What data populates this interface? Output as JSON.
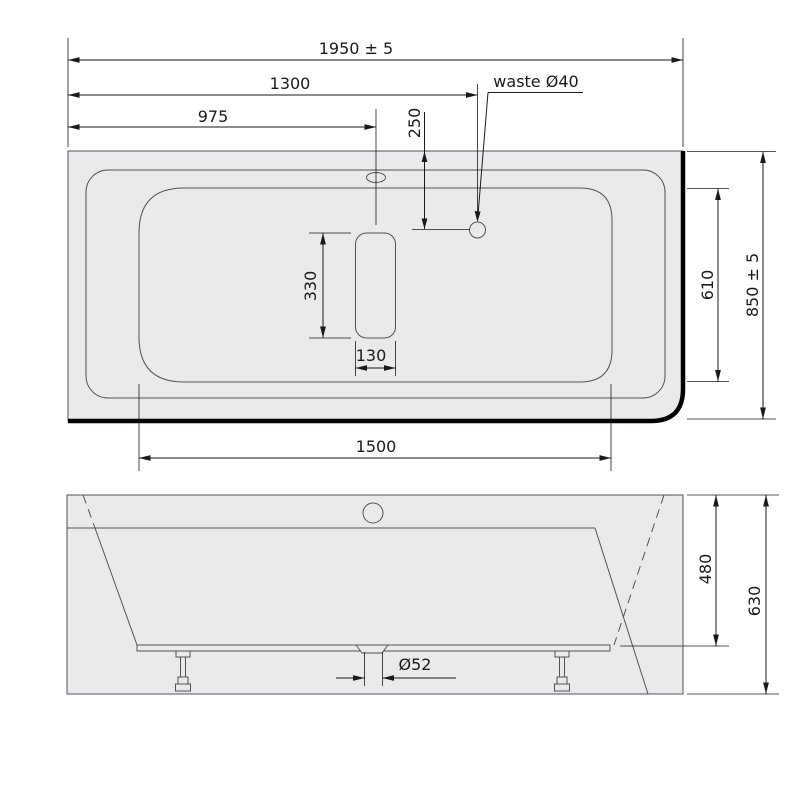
{
  "drawing": {
    "type": "bathtub-technical-drawing",
    "colors": {
      "body_fill": "#e9eaeb",
      "outline": "#4f5356",
      "dimension": "#1a1a1a",
      "thick_edge": "#000000"
    },
    "top_view": {
      "dims": {
        "overall_length": "1950 ± 5",
        "waste_offset_x": "1300",
        "overflow_offset_x": "975",
        "waste_offset_y": "250",
        "waste_note": "waste Ø40",
        "headrest_length": "330",
        "headrest_width": "130",
        "inner_width_right": "610",
        "overall_width": "850 ± 5",
        "inner_length": "1500"
      }
    },
    "front_view": {
      "dims": {
        "body_height": "480",
        "total_height": "630",
        "drain_diameter": "Ø52"
      }
    }
  }
}
